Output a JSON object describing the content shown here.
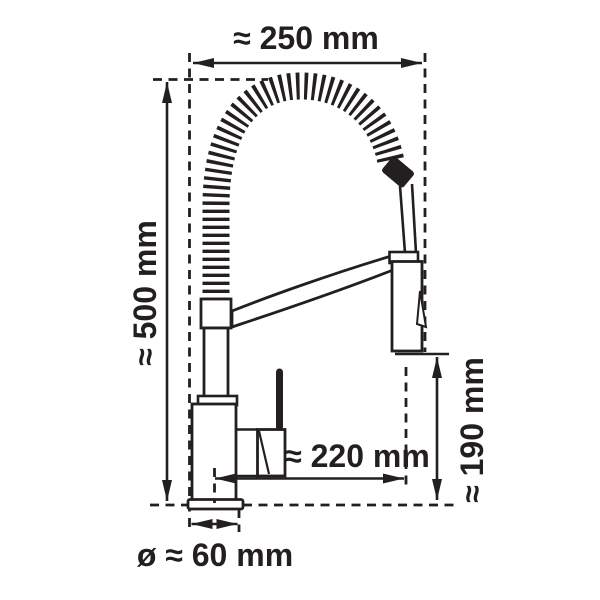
{
  "figure": {
    "subject": "kitchen faucet with spring spout - technical dimension drawing, side view",
    "background_color": "#ffffff",
    "ink_color": "#231f20",
    "dimensions": {
      "overall_width": "≈ 250 mm",
      "overall_height": "≈ 500 mm",
      "spout_clearance": "≈ 190 mm",
      "spout_reach": "≈ 220 mm",
      "base_diameter": "ø ≈ 60 mm"
    }
  }
}
